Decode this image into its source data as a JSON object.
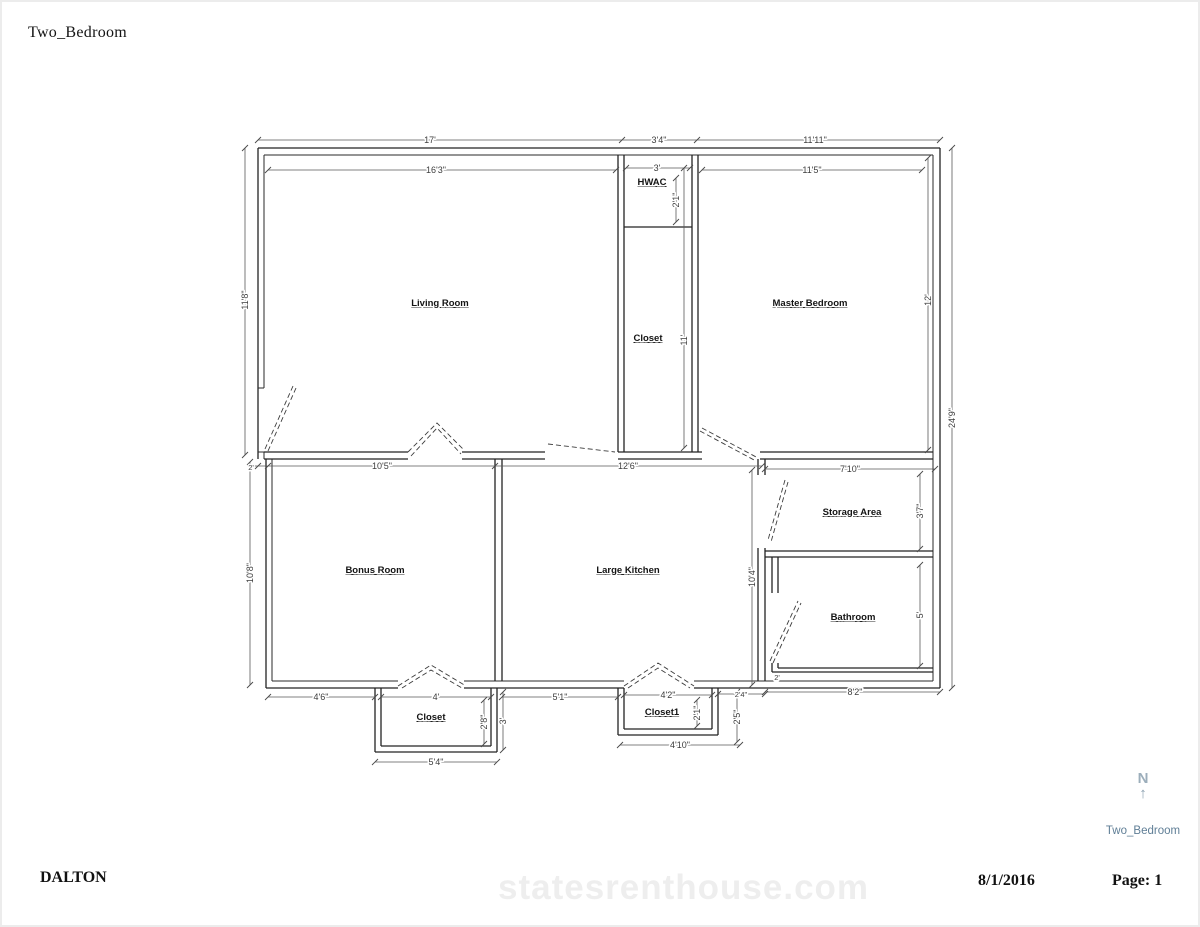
{
  "page": {
    "title": "Two_Bedroom",
    "footer_name": "DALTON",
    "footer_date": "8/1/2016",
    "footer_page": "Page: 1",
    "watermark": "statesrenthouse.com"
  },
  "north": {
    "letter": "N",
    "arrow": "↑",
    "plan_label": "Two_Bedroom"
  },
  "rooms": {
    "living": "Living Room",
    "hwac": "HWAC",
    "closet": "Closet",
    "master": "Master Bedroom",
    "bonus": "Bonus Room",
    "kitchen": "Large Kitchen",
    "storage": "Storage Area",
    "bathroom": "Bathroom",
    "bonus_closet": "Closet",
    "kitchen_closet": "Closet1"
  },
  "dims": {
    "top_total": "17'",
    "top_hwac": "3'4\"",
    "top_master": "11'11\"",
    "living_width": "16'3\"",
    "hwac_width": "3'",
    "hwac_depth": "2'1\"",
    "master_width": "11'5\"",
    "living_height": "11'8\"",
    "right_total": "24'9\"",
    "master_height": "12'",
    "closet_height": "11'",
    "band_offset": "2'",
    "bonus_width": "10'5\"",
    "kitchen_width": "12'6\"",
    "storage_width": "7'10\"",
    "bonus_height": "10'8\"",
    "right_mid_height": "10'4\"",
    "storage_height": "3'7\"",
    "bathroom_height": "5'",
    "bathroom_width": "8'2\"",
    "bath_notch": "2'",
    "bonus_closet_offset": "4'6\"",
    "bonus_closet_width": "4'",
    "bonus_closet_depth": "2'8\"",
    "bonus_closet_outer": "3'",
    "bonus_closet_total": "5'4\"",
    "kitchen_closet_offset": "5'1\"",
    "kitchen_closet_width": "4'2\"",
    "kitchen_closet_depth": "2'1\"",
    "kitchen_closet_outer": "2'5\"",
    "kitchen_closet_right": "2'4\"",
    "kitchen_closet_total": "4'10\""
  },
  "colors": {
    "wall": "#232323",
    "dimension_text": "#3d3d3d",
    "north_indicator": "#8ba0b0",
    "north_label": "#5f7e96",
    "watermark": "#eaeaea"
  }
}
